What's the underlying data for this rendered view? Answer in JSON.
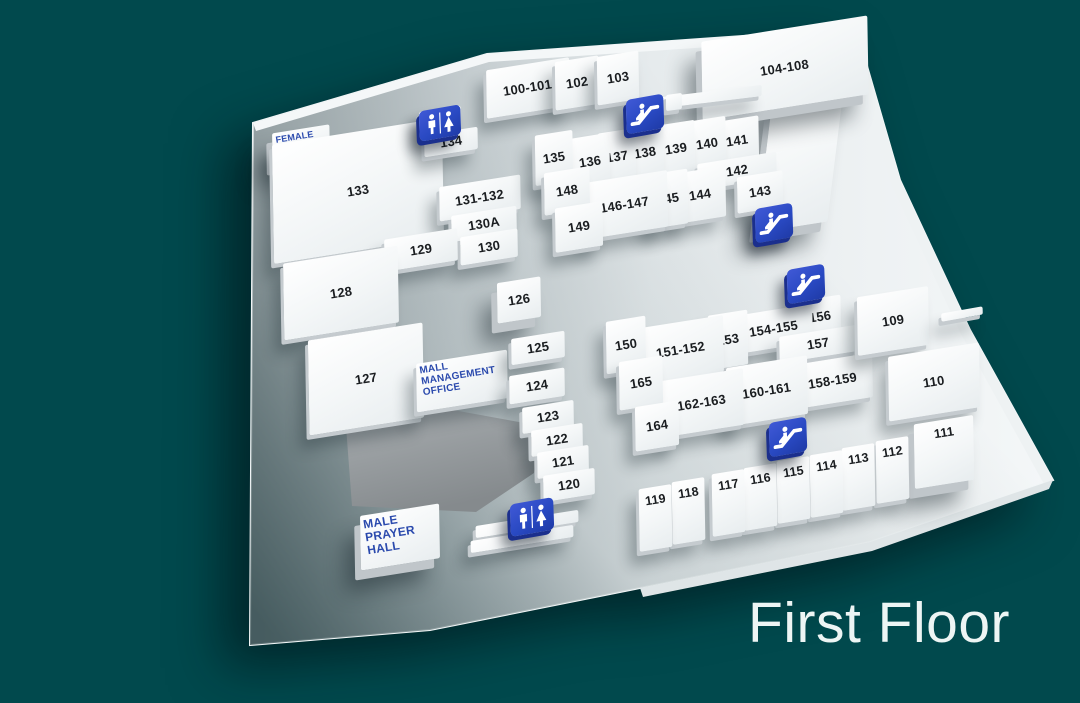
{
  "title": "First Floor",
  "colors": {
    "background": "#01494d",
    "floor": "#e8eced",
    "unit_fill": "#fbfdfe",
    "unit_text": "#1a1d20",
    "room_label_blue": "#2b4aad",
    "icon_blue": "#2949c2",
    "service_area_gray": "#9aa0a3",
    "title_text": "#edf5f4"
  },
  "floor_plan": {
    "units": [
      {
        "label": "100-101",
        "cx": 528,
        "cy": 88,
        "w": 84,
        "h": 48
      },
      {
        "label": "102",
        "cx": 577,
        "cy": 83,
        "w": 44,
        "h": 48
      },
      {
        "label": "103",
        "cx": 618,
        "cy": 78,
        "w": 42,
        "h": 48
      },
      {
        "label": "",
        "name": "unit-104-108-leg",
        "cx": 800,
        "cy": 160,
        "w": 72,
        "h": 130,
        "r": -9,
        "sk": -16,
        "cls": "tall"
      },
      {
        "label": "104-108",
        "cx": 785,
        "cy": 68,
        "w": 168,
        "h": 78,
        "r": -9,
        "cls": "tall"
      },
      {
        "label": "",
        "name": "wall-segment",
        "cx": 712,
        "cy": 96,
        "w": 100,
        "h": 11,
        "r": -7
      },
      {
        "label": "",
        "name": "wall-step",
        "cx": 674,
        "cy": 102,
        "w": 16,
        "h": 16,
        "r": -8
      },
      {
        "label": "FEMALE\nPRAYER\nHALL",
        "name": "female-prayer-hall",
        "cx": 301,
        "cy": 145,
        "w": 58,
        "h": 32,
        "cls": "blue tall",
        "fs": 9
      },
      {
        "label": "133",
        "cx": 358,
        "cy": 191,
        "w": 172,
        "h": 118
      },
      {
        "label": "",
        "name": "restroom-pedestal",
        "cx": 440,
        "cy": 121,
        "w": 42,
        "h": 24
      },
      {
        "label": "134",
        "cx": 451,
        "cy": 142,
        "w": 54,
        "h": 22
      },
      {
        "label": "131-132",
        "cx": 480,
        "cy": 198,
        "w": 82,
        "h": 34
      },
      {
        "label": "130A",
        "cx": 484,
        "cy": 224,
        "w": 66,
        "h": 26
      },
      {
        "label": "130",
        "cx": 489,
        "cy": 247,
        "w": 58,
        "h": 28
      },
      {
        "label": "129",
        "cx": 421,
        "cy": 250,
        "w": 74,
        "h": 32
      },
      {
        "label": "128",
        "cx": 341,
        "cy": 293,
        "w": 116,
        "h": 76
      },
      {
        "label": "127",
        "cx": 366,
        "cy": 379,
        "w": 116,
        "h": 94
      },
      {
        "label": "126",
        "cx": 519,
        "cy": 300,
        "w": 44,
        "h": 40,
        "cls": "tall"
      },
      {
        "label": "MALL\nMANAGEMENT\nOFFICE",
        "name": "mall-management-office",
        "cx": 462,
        "cy": 381,
        "w": 92,
        "h": 48,
        "cls": "blue",
        "fs": 10
      },
      {
        "label": "125",
        "cx": 538,
        "cy": 348,
        "w": 54,
        "h": 26
      },
      {
        "label": "124",
        "cx": 537,
        "cy": 386,
        "w": 56,
        "h": 28
      },
      {
        "label": "123",
        "cx": 548,
        "cy": 417,
        "w": 52,
        "h": 26
      },
      {
        "label": "122",
        "cx": 557,
        "cy": 440,
        "w": 52,
        "h": 26
      },
      {
        "label": "121",
        "cx": 563,
        "cy": 462,
        "w": 52,
        "h": 26
      },
      {
        "label": "120",
        "cx": 569,
        "cy": 485,
        "w": 52,
        "h": 26
      },
      {
        "label": "MALE\nPRAYER\nHALL",
        "name": "male-prayer-hall",
        "cx": 400,
        "cy": 537,
        "w": 80,
        "h": 54,
        "cls": "blue tall",
        "fs": 12
      },
      {
        "label": "",
        "name": "wall-strip",
        "cx": 527,
        "cy": 524,
        "w": 104,
        "h": 12
      },
      {
        "label": "",
        "name": "wall-strip",
        "cx": 522,
        "cy": 539,
        "w": 104,
        "h": 12
      },
      {
        "label": "141",
        "cx": 737,
        "cy": 141,
        "w": 44,
        "h": 44
      },
      {
        "label": "140",
        "cx": 707,
        "cy": 144,
        "w": 38,
        "h": 50
      },
      {
        "label": "139",
        "cx": 676,
        "cy": 149,
        "w": 38,
        "h": 52
      },
      {
        "label": "138",
        "cx": 645,
        "cy": 153,
        "w": 38,
        "h": 52
      },
      {
        "label": "137",
        "cx": 617,
        "cy": 157,
        "w": 38,
        "h": 52
      },
      {
        "label": "136",
        "cx": 590,
        "cy": 162,
        "w": 40,
        "h": 52
      },
      {
        "label": "135",
        "cx": 554,
        "cy": 158,
        "w": 38,
        "h": 50
      },
      {
        "label": "142",
        "cx": 737,
        "cy": 171,
        "w": 80,
        "h": 26
      },
      {
        "label": "143",
        "cx": 760,
        "cy": 192,
        "w": 46,
        "h": 36
      },
      {
        "label": "144",
        "cx": 700,
        "cy": 195,
        "w": 52,
        "h": 50
      },
      {
        "label": "145",
        "cx": 668,
        "cy": 199,
        "w": 40,
        "h": 54
      },
      {
        "label": "146-147",
        "cx": 625,
        "cy": 205,
        "w": 86,
        "h": 56
      },
      {
        "label": "148",
        "cx": 567,
        "cy": 191,
        "w": 46,
        "h": 42
      },
      {
        "label": "149",
        "cx": 579,
        "cy": 227,
        "w": 48,
        "h": 44
      },
      {
        "label": "156",
        "cx": 820,
        "cy": 317,
        "w": 42,
        "h": 38
      },
      {
        "label": "154-155",
        "cx": 774,
        "cy": 329,
        "w": 78,
        "h": 38
      },
      {
        "label": "153",
        "cx": 728,
        "cy": 340,
        "w": 40,
        "h": 54
      },
      {
        "label": "151-152",
        "cx": 681,
        "cy": 350,
        "w": 86,
        "h": 56
      },
      {
        "label": "150",
        "cx": 626,
        "cy": 345,
        "w": 40,
        "h": 52
      },
      {
        "label": "157",
        "cx": 818,
        "cy": 344,
        "w": 78,
        "h": 26
      },
      {
        "label": "158-159",
        "cx": 833,
        "cy": 381,
        "w": 80,
        "h": 44
      },
      {
        "label": "160-161",
        "cx": 767,
        "cy": 391,
        "w": 82,
        "h": 58
      },
      {
        "label": "162-163",
        "cx": 702,
        "cy": 403,
        "w": 84,
        "h": 56
      },
      {
        "label": "165",
        "cx": 641,
        "cy": 383,
        "w": 44,
        "h": 48
      },
      {
        "label": "164",
        "cx": 657,
        "cy": 426,
        "w": 44,
        "h": 44
      },
      {
        "label": "109",
        "cx": 893,
        "cy": 321,
        "w": 72,
        "h": 58
      },
      {
        "label": "",
        "name": "wall-segment",
        "cx": 962,
        "cy": 314,
        "w": 42,
        "h": 8,
        "r": -10
      },
      {
        "label": "110",
        "cx": 934,
        "cy": 382,
        "w": 92,
        "h": 64
      },
      {
        "label": "111",
        "cx": 944,
        "cy": 452,
        "w": 60,
        "h": 64,
        "cls": "tall v"
      },
      {
        "label": "112",
        "cx": 892,
        "cy": 470,
        "w": 33,
        "h": 62,
        "cls": "v"
      },
      {
        "label": "113",
        "cx": 858,
        "cy": 477,
        "w": 33,
        "h": 62,
        "cls": "v"
      },
      {
        "label": "114",
        "cx": 826,
        "cy": 484,
        "w": 33,
        "h": 62,
        "cls": "v"
      },
      {
        "label": "115",
        "cx": 793,
        "cy": 490,
        "w": 33,
        "h": 62,
        "cls": "v"
      },
      {
        "label": "116",
        "cx": 760,
        "cy": 497,
        "w": 33,
        "h": 62,
        "cls": "v"
      },
      {
        "label": "117",
        "cx": 728,
        "cy": 503,
        "w": 33,
        "h": 62,
        "cls": "v"
      },
      {
        "label": "118",
        "cx": 688,
        "cy": 511,
        "w": 33,
        "h": 62,
        "cls": "v"
      },
      {
        "label": "119",
        "cx": 655,
        "cy": 518,
        "w": 33,
        "h": 62,
        "cls": "v"
      }
    ],
    "icons": [
      {
        "type": "escalator",
        "cx": 643,
        "cy": 112,
        "w": 34,
        "h": 30
      },
      {
        "type": "escalator",
        "cx": 772,
        "cy": 221,
        "w": 34,
        "h": 30
      },
      {
        "type": "escalator",
        "cx": 804,
        "cy": 282,
        "w": 34,
        "h": 30
      },
      {
        "type": "escalator",
        "cx": 786,
        "cy": 435,
        "w": 34,
        "h": 30
      },
      {
        "type": "restroom",
        "cx": 438,
        "cy": 121,
        "w": 38,
        "h": 26
      },
      {
        "type": "restroom",
        "cx": 530,
        "cy": 515,
        "w": 40,
        "h": 28
      }
    ]
  }
}
